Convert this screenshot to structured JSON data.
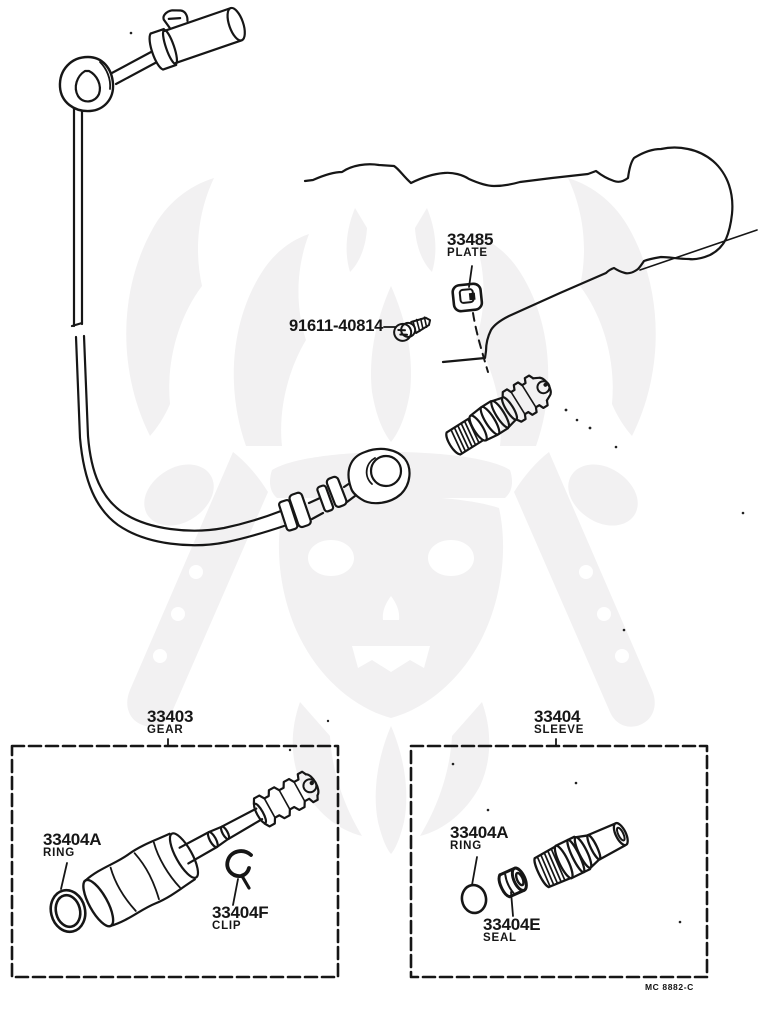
{
  "page": {
    "footer_code": "MC 8882-C"
  },
  "colors": {
    "line": "#161616",
    "background": "#ffffff",
    "watermark": "#f2f1f2"
  },
  "callouts": {
    "plate": {
      "part_no": "33485",
      "label": "PLATE"
    },
    "screw": {
      "part_no": "91611-40814"
    },
    "gear_group": {
      "part_no": "33403",
      "label": "GEAR"
    },
    "sleeve_group": {
      "part_no": "33404",
      "label": "SLEEVE"
    },
    "gear_ring": {
      "part_no": "33404A",
      "label": "RING"
    },
    "gear_clip": {
      "part_no": "33404F",
      "label": "CLIP"
    },
    "sleeve_ring": {
      "part_no": "33404A",
      "label": "RING"
    },
    "sleeve_seal": {
      "part_no": "33404E",
      "label": "SEAL"
    }
  }
}
